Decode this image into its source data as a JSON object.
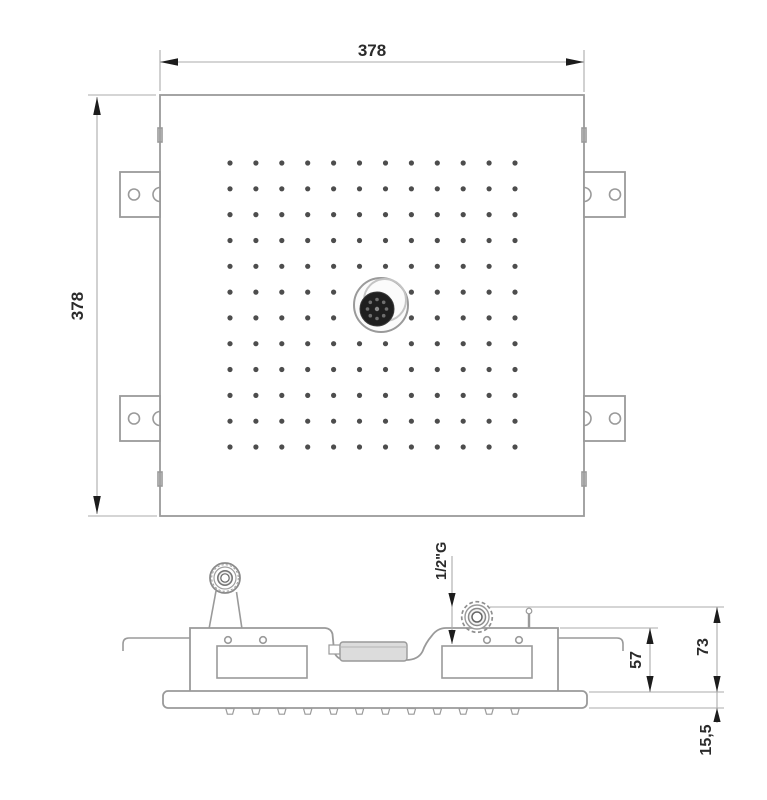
{
  "drawing": {
    "type": "technical-dimension-drawing",
    "views": {
      "top": {
        "width_label": "378",
        "height_label": "378",
        "spray_grid": {
          "rows": 12,
          "cols": 12,
          "dots_hidden_by_center_fitting": 4
        },
        "mounting_brackets": 4,
        "bracket_holes_each": 2
      },
      "side": {
        "inlet_label": "1/2\"G",
        "housing_depth_label": "57",
        "total_depth_label": "73",
        "plate_thickness_label": "15,5",
        "nozzle_count": 12
      }
    },
    "colors": {
      "outline": "#9a9a9a",
      "dim_line": "#ababab",
      "arrow": "#1c1c1c",
      "text": "#2b2b2b",
      "dot": "#4d4d4d",
      "fitting_dark": "#1f1f1f",
      "background": "#ffffff"
    }
  }
}
